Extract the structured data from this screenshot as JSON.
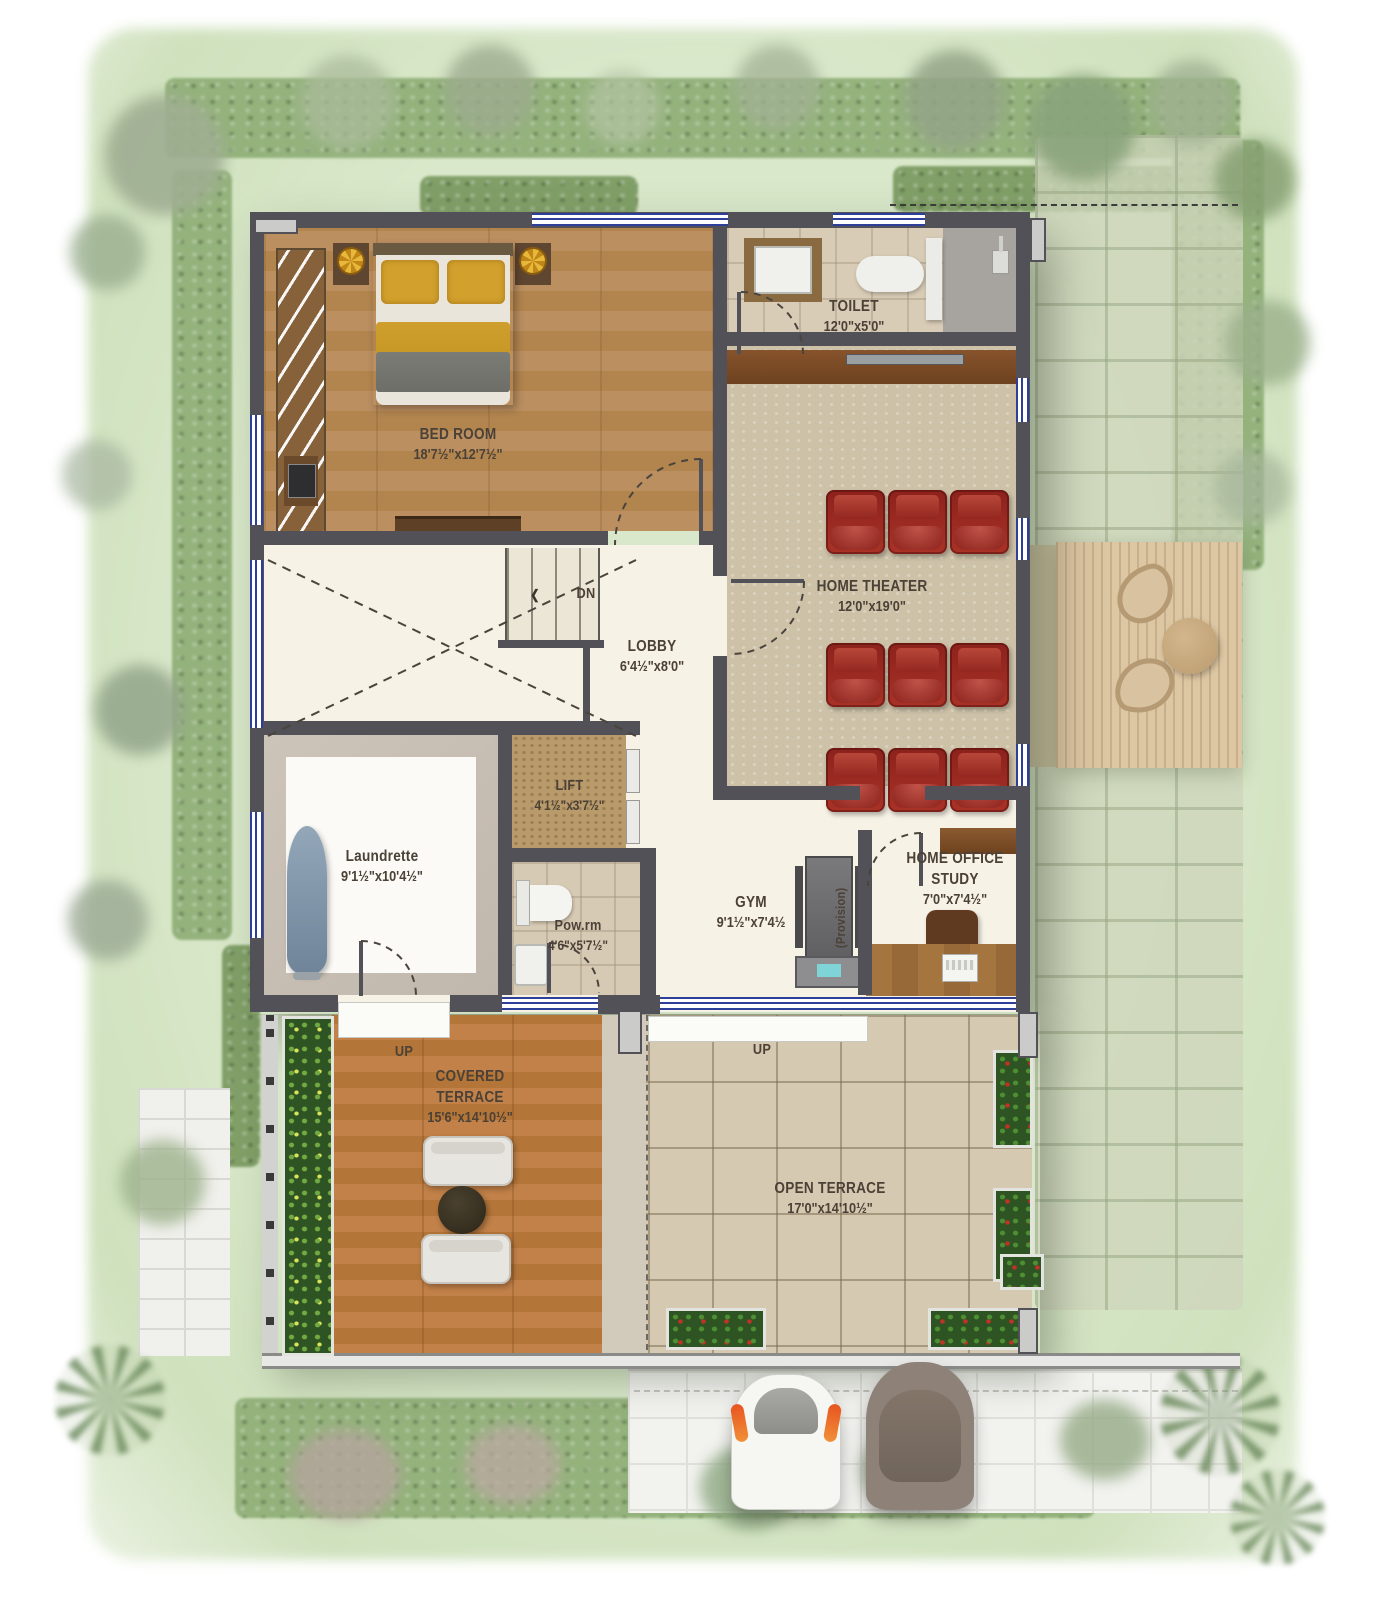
{
  "rooms": {
    "bedroom": {
      "name": "BED ROOM",
      "dims": "18'7½\"x12'7½\""
    },
    "toilet": {
      "name": "TOILET",
      "dims": "12'0\"x5'0\""
    },
    "home_theater": {
      "name": "HOME THEATER",
      "dims": "12'0\"x19'0\""
    },
    "lobby": {
      "name": "LOBBY",
      "dims": "6'4½\"x8'0\""
    },
    "lift": {
      "name": "LIFT",
      "dims": "4'1½\"x3'7½\""
    },
    "laundrette": {
      "name": "Laundrette",
      "dims": "9'1½\"x10'4½\""
    },
    "powder_room": {
      "name": "Pow.rm",
      "dims": "4'6\"x5'7½\""
    },
    "gym": {
      "name": "GYM",
      "dims": "9'1½\"x7'4½"
    },
    "home_office": {
      "name_line1": "HOME OFFICE",
      "name_line2": "STUDY",
      "dims": "7'0\"x7'4½\""
    },
    "covered_terrace": {
      "name_line1": "COVERED",
      "name_line2": "TERRACE",
      "dims": "15'6\"x14'10½\""
    },
    "open_terrace": {
      "name": "OPEN TERRACE",
      "dims": "17'0\"x14'10½\""
    }
  },
  "annotations": {
    "stairs_down": "DN",
    "stairs_arrow": "❮",
    "covered_terrace_up": "UP",
    "open_terrace_up": "UP",
    "provision": "(Provision)"
  },
  "palette": {
    "wall": "#525157",
    "window_blue": "#2e3f9a",
    "theater_seat_red": "#a0291f",
    "bed_yellow": "#d2a02c",
    "lawn_green": "#d5e6c6",
    "terrace_wood": "#bf8147",
    "bedroom_wood": "#b98c5c",
    "tile_beige": "#d6c9b1"
  }
}
